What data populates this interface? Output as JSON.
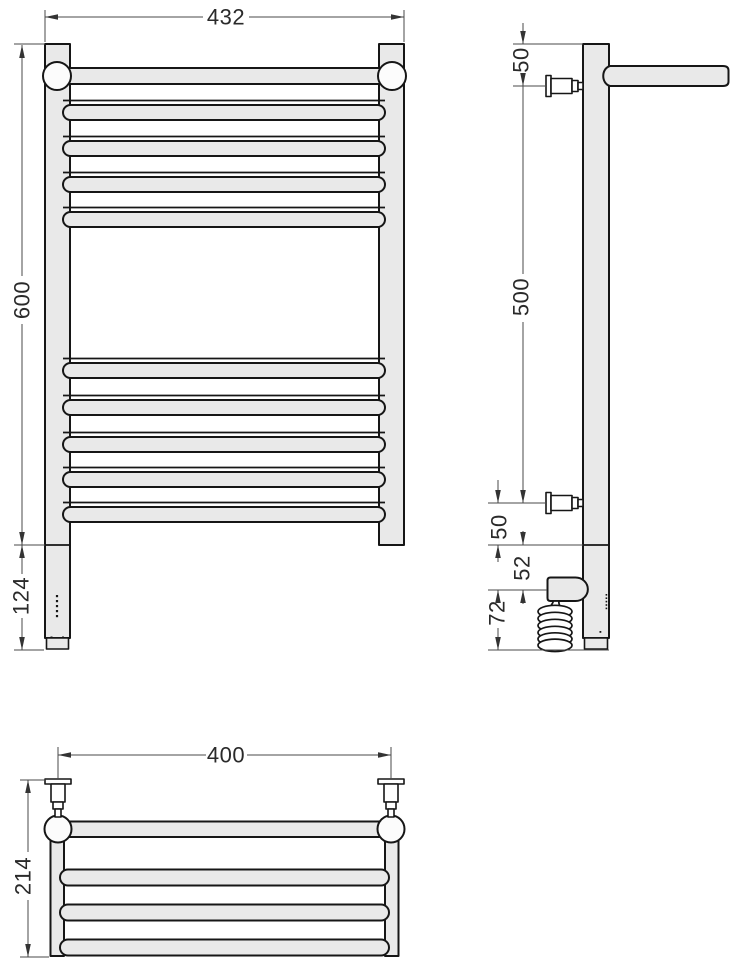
{
  "views": {
    "front": {
      "overall_width": "432",
      "height": "600",
      "lower_section_height": "124"
    },
    "side": {
      "top_to_upper_bracket": "50",
      "bracket_spacing": "500",
      "lower_bracket_to_section": "50",
      "section_to_heater_box": "52",
      "heater_zone_height": "72"
    },
    "top": {
      "bracket_spacing_width": "400",
      "overall_depth": "214"
    }
  },
  "colors": {
    "background": "#ffffff",
    "part_fill": "#e9e9e9",
    "part_outline": "#161616",
    "joint_fill": "#fcfcfc",
    "dimension_line": "#4a4a4a",
    "label_text": "#2a2a2a"
  }
}
